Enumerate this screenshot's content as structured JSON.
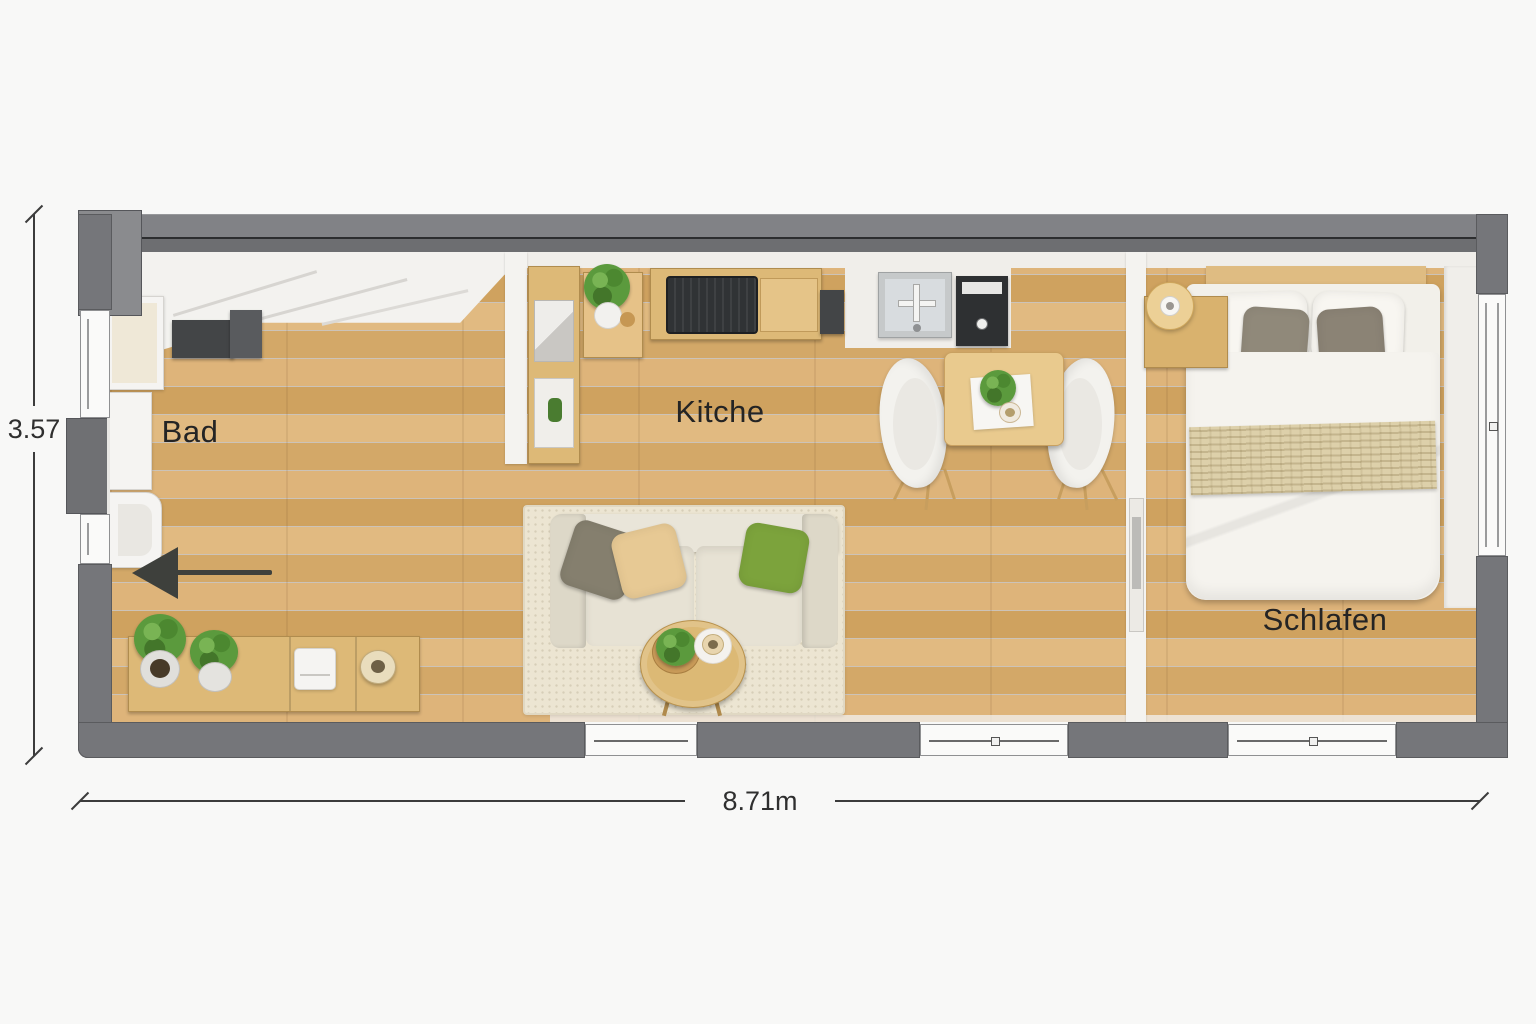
{
  "rooms": {
    "bad": "Bad",
    "kitchen": "Kitche",
    "schlafen": "Schlafen"
  },
  "dimensions": {
    "height": "3.57",
    "width": "8.71m"
  },
  "colors": {
    "wall_gray": "#75767a",
    "wood_floor": "#d7ab6d",
    "rug_beige": "#ece5d2",
    "sofa_cream": "#e6e1d3",
    "pillow_green": "#7ca33c",
    "pillow_beige": "#e7c994",
    "pillow_gray": "#857f6e",
    "blanket_knit": "#ddd0aa",
    "plant_green": "#5b9a3d",
    "annotation_dark": "#2f2f2f"
  },
  "icons": {
    "entrance_arrow": "arrow-left",
    "potted_plant": "potted-plant",
    "sink_faucet": "cross-faucet",
    "cooktop": "stove-grill"
  }
}
